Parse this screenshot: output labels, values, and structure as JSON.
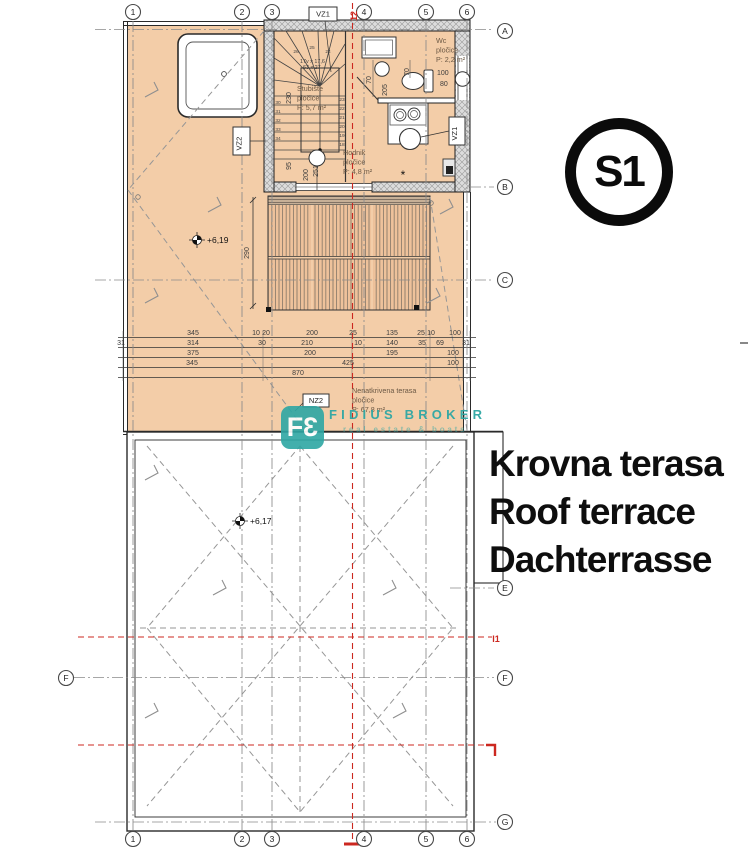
{
  "drawing": {
    "badge": "S1",
    "title": {
      "hr": "Krovna terasa",
      "en": "Roof terrace",
      "de": "Dachterrasse"
    },
    "watermark": {
      "logo_f": "F",
      "logo_3": "3",
      "name": "FIDIUS BROKER",
      "tagline": "real estate & boats"
    },
    "colors": {
      "accent_red": "#cc2820",
      "watermark_teal": "#2ea7a4",
      "terrace_fill": "#f3cda8"
    }
  },
  "grid": {
    "top_y": 12,
    "bottom_y": 839,
    "columns": [
      {
        "label": "1",
        "x": 133
      },
      {
        "label": "2",
        "x": 242
      },
      {
        "label": "3",
        "x": 272
      },
      {
        "label": "4",
        "x": 364
      },
      {
        "label": "5",
        "x": 426
      },
      {
        "label": "6",
        "x": 467
      }
    ],
    "rows": [
      {
        "label": "A",
        "x": 505,
        "y": 31
      },
      {
        "label": "B",
        "x": 505,
        "y": 187
      },
      {
        "label": "C",
        "x": 505,
        "y": 280
      },
      {
        "label": "E",
        "x": 505,
        "y": 588
      },
      {
        "label": "F",
        "x": 66,
        "y": 678
      },
      {
        "label": "F",
        "x": 505,
        "y": 678
      },
      {
        "label": "G",
        "x": 505,
        "y": 822
      }
    ]
  },
  "rooms": [
    {
      "name": "Wc",
      "material": "pločice",
      "area": "P: 2,2 m²",
      "x": 436,
      "y": 43
    },
    {
      "name": "Stubište",
      "material": "pločice",
      "area": "P: 5,7 m²",
      "x": 297,
      "y": 91
    },
    {
      "name": "Hodnik",
      "material": "pločice",
      "area": "P: 4,8 m²",
      "x": 343,
      "y": 155
    },
    {
      "name": "Nenatkrivena terasa",
      "material": "pločice",
      "area": "P: 67,8 m²",
      "x": 352,
      "y": 393
    }
  ],
  "levels": [
    {
      "value": "+6,19",
      "x": 197,
      "y": 240
    },
    {
      "value": "+6,17",
      "x": 240,
      "y": 521
    }
  ],
  "tags": [
    {
      "label": "VZ1",
      "x": 309,
      "y": 7,
      "w": 28,
      "h": 14,
      "rot": 0
    },
    {
      "label": "VZ2",
      "x": 233,
      "y": 127,
      "w": 17,
      "h": 28,
      "rot": -90
    },
    {
      "label": "VZ1",
      "x": 449,
      "y": 117,
      "w": 16,
      "h": 28,
      "rot": -90
    },
    {
      "label": "NZ2",
      "x": 303,
      "y": 394,
      "w": 26,
      "h": 13,
      "rot": 0
    }
  ],
  "section_marks": [
    {
      "label": "12",
      "x": 357,
      "y": 16,
      "rot": -90
    },
    {
      "label": "I1",
      "x": 496,
      "y": 642,
      "rot": 0
    }
  ],
  "dimensions": {
    "rows": [
      {
        "y": 335,
        "items": [
          {
            "t": "345",
            "x": 193
          },
          {
            "t": "10",
            "x": 256
          },
          {
            "t": "20",
            "x": 266
          },
          {
            "t": "200",
            "x": 312
          },
          {
            "t": "25",
            "x": 353
          },
          {
            "t": "135",
            "x": 392
          },
          {
            "t": "25",
            "x": 421
          },
          {
            "t": "10",
            "x": 431
          },
          {
            "t": "100",
            "x": 455
          }
        ]
      },
      {
        "y": 345,
        "items": [
          {
            "t": "31",
            "x": 121
          },
          {
            "t": "314",
            "x": 193
          },
          {
            "t": "30",
            "x": 262
          },
          {
            "t": "210",
            "x": 307
          },
          {
            "t": "10",
            "x": 358
          },
          {
            "t": "140",
            "x": 392
          },
          {
            "t": "35",
            "x": 422
          },
          {
            "t": "69",
            "x": 440
          },
          {
            "t": "31",
            "x": 466
          }
        ]
      },
      {
        "y": 355,
        "items": [
          {
            "t": "375",
            "x": 193
          },
          {
            "t": "200",
            "x": 310
          },
          {
            "t": "195",
            "x": 392
          },
          {
            "t": "100",
            "x": 453
          }
        ]
      },
      {
        "y": 365,
        "items": [
          {
            "t": "345",
            "x": 192
          },
          {
            "t": "425",
            "x": 348
          },
          {
            "t": "100",
            "x": 453
          }
        ]
      },
      {
        "y": 375,
        "items": [
          {
            "t": "870",
            "x": 298
          }
        ]
      }
    ],
    "vertical": [
      {
        "t": "290",
        "x": 249,
        "y": 253
      },
      {
        "t": "230",
        "x": 291,
        "y": 98
      },
      {
        "t": "95",
        "x": 291,
        "y": 166
      },
      {
        "t": "200",
        "x": 308,
        "y": 175
      },
      {
        "t": "251",
        "x": 318,
        "y": 171
      },
      {
        "t": "70",
        "x": 371,
        "y": 80
      },
      {
        "t": "205",
        "x": 387,
        "y": 90
      },
      {
        "t": "70",
        "x": 409,
        "y": 72
      }
    ],
    "small": [
      {
        "t": "100",
        "x": 437,
        "y": 75
      },
      {
        "t": "80",
        "x": 440,
        "y": 86
      }
    ]
  },
  "stair": {
    "note": [
      {
        "t": "17v x 17,6",
        "x": 300,
        "y": 63
      },
      {
        "t": "63 x 27",
        "x": 303,
        "y": 69
      }
    ],
    "steps": [
      {
        "t": "26",
        "x": 296,
        "y": 53
      },
      {
        "t": "25",
        "x": 312,
        "y": 49
      },
      {
        "t": "24",
        "x": 328,
        "y": 53
      },
      {
        "t": "23",
        "x": 342,
        "y": 101
      },
      {
        "t": "22",
        "x": 342,
        "y": 110
      },
      {
        "t": "21",
        "x": 342,
        "y": 119
      },
      {
        "t": "20",
        "x": 342,
        "y": 128
      },
      {
        "t": "19",
        "x": 342,
        "y": 137
      },
      {
        "t": "18",
        "x": 342,
        "y": 146
      },
      {
        "t": "30",
        "x": 278,
        "y": 104
      },
      {
        "t": "31",
        "x": 278,
        "y": 113
      },
      {
        "t": "32",
        "x": 278,
        "y": 122
      },
      {
        "t": "33",
        "x": 278,
        "y": 131
      },
      {
        "t": "34",
        "x": 278,
        "y": 140
      }
    ]
  },
  "notes": [
    {
      "t": "*",
      "x": 403,
      "y": 179,
      "size": 12
    }
  ]
}
